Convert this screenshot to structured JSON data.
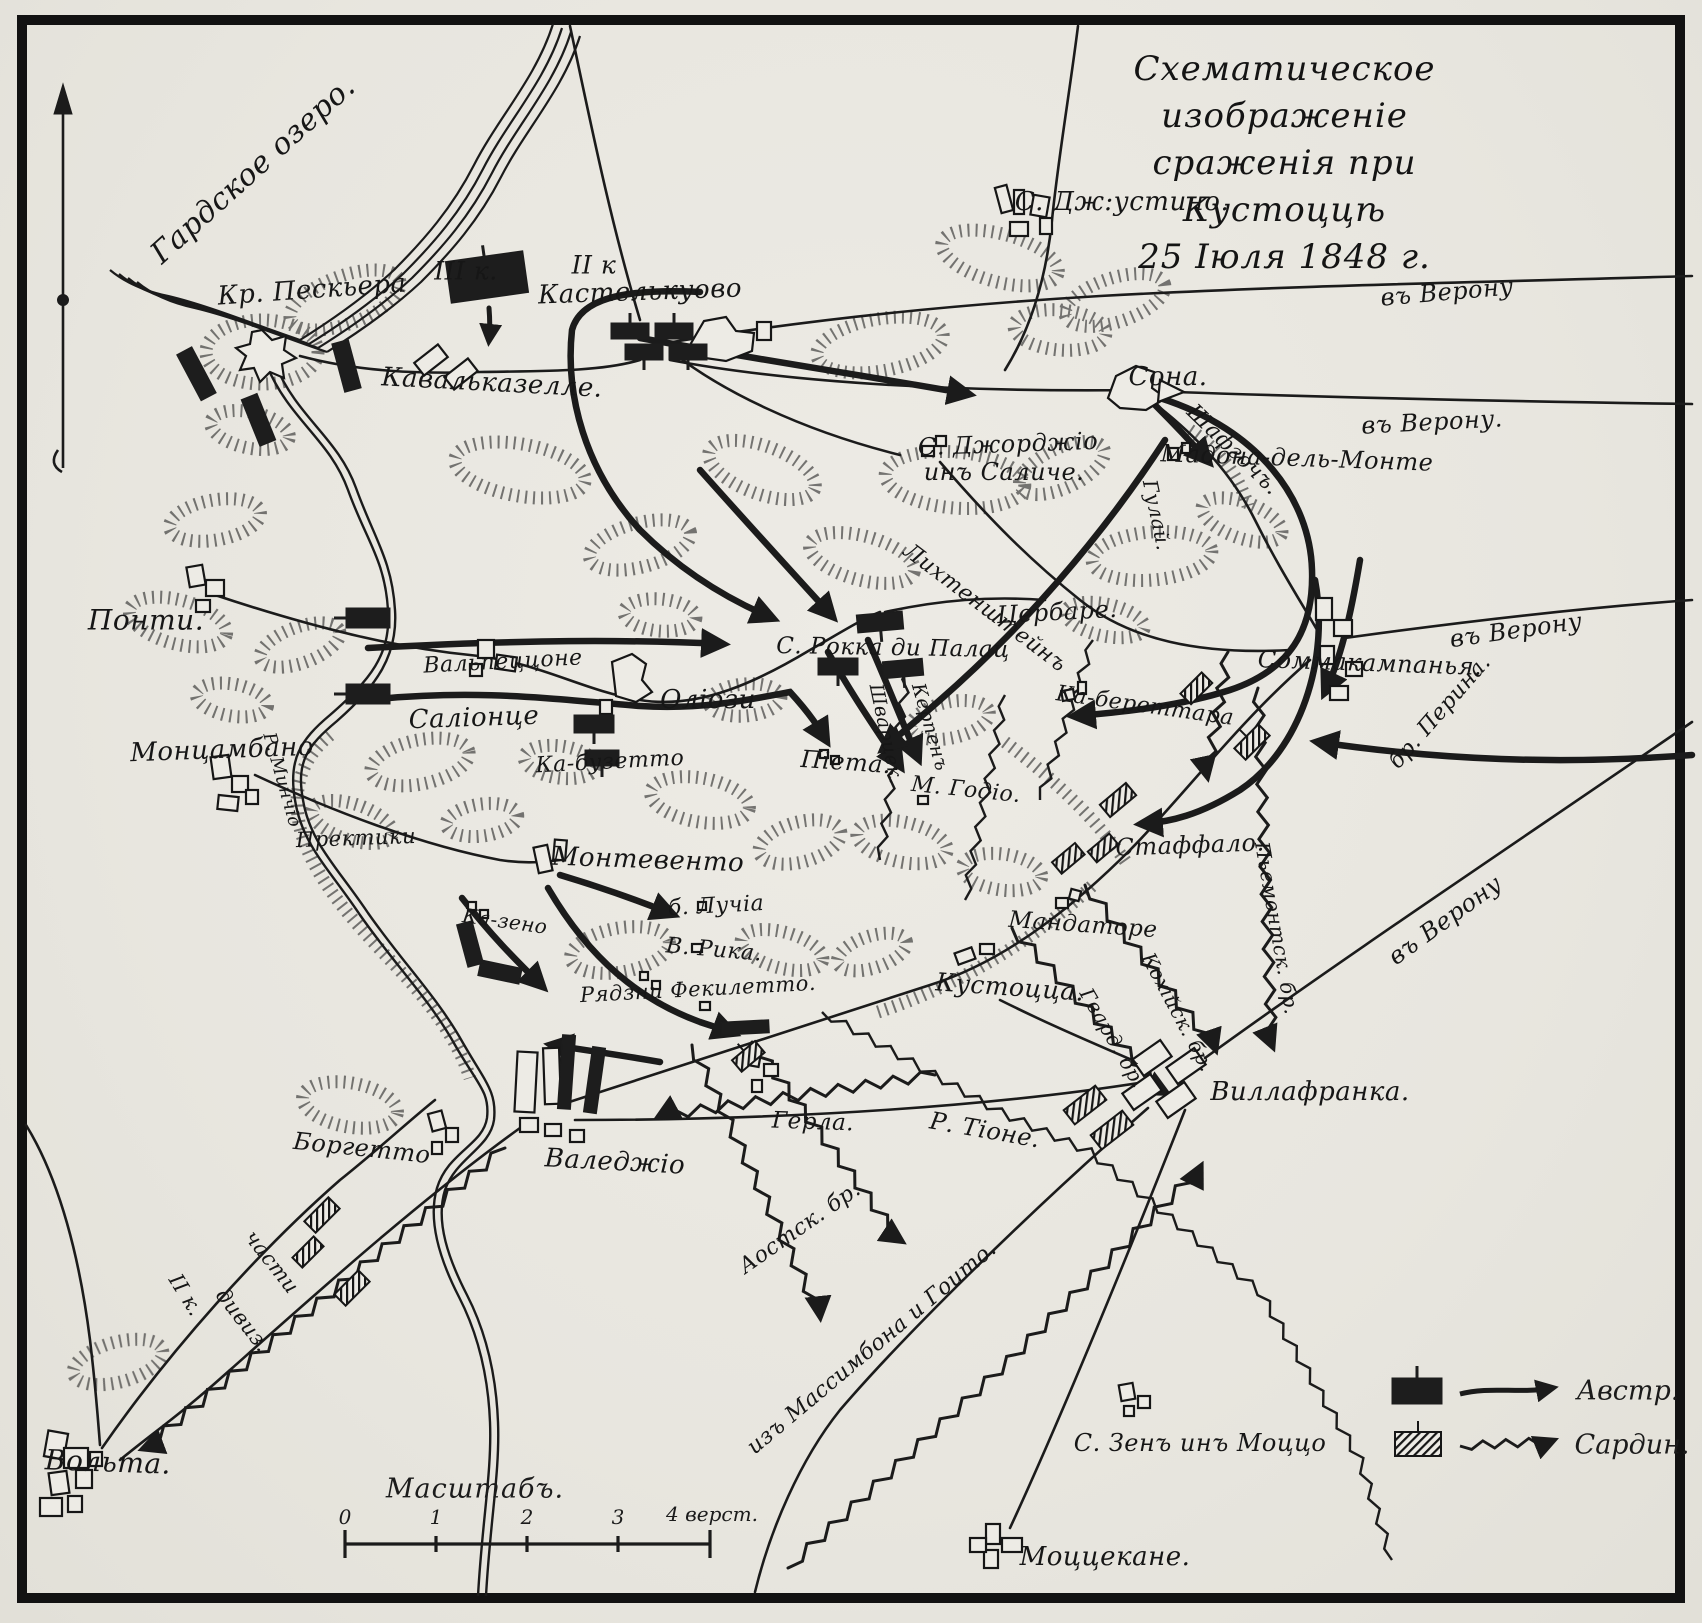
{
  "title": {
    "lines": [
      "Схематическое изображеніе",
      "сраженія при Кустоццѣ",
      "25 Іюля 1848 г."
    ]
  },
  "legend": {
    "austrian_label": "Австр.",
    "sardinian_label": "Сардин."
  },
  "scale": {
    "caption": "Масштабъ.",
    "tick_labels": [
      "0",
      "1",
      "2",
      "3"
    ],
    "end_label": "4 верст."
  },
  "compass": {
    "direction": "north"
  },
  "labels": [
    {
      "text": "Гардское озеро.",
      "x": 253,
      "y": 170,
      "size": 30,
      "rot": -42
    },
    {
      "text": "Кр. Пескьера",
      "x": 312,
      "y": 290,
      "size": 26,
      "rot": -4
    },
    {
      "text": "III к.",
      "x": 466,
      "y": 271,
      "size": 25,
      "rot": 0
    },
    {
      "text": "II к",
      "x": 594,
      "y": 265,
      "size": 25,
      "rot": 0
    },
    {
      "text": "Кастелькуово",
      "x": 640,
      "y": 292,
      "size": 26,
      "rot": -2
    },
    {
      "text": "Кавальказелле.",
      "x": 492,
      "y": 383,
      "size": 26,
      "rot": 3
    },
    {
      "text": "С. Дж:устино.",
      "x": 1122,
      "y": 202,
      "size": 26,
      "rot": 0
    },
    {
      "text": "въ Верону",
      "x": 1447,
      "y": 292,
      "size": 24,
      "rot": -5
    },
    {
      "text": "въ Верону.",
      "x": 1432,
      "y": 422,
      "size": 24,
      "rot": -3
    },
    {
      "text": "Сона.",
      "x": 1168,
      "y": 377,
      "size": 26,
      "rot": 0
    },
    {
      "text": "Шафгочъ.",
      "x": 1233,
      "y": 450,
      "size": 22,
      "rot": 44
    },
    {
      "text": "Мадона-дель-Монте",
      "x": 1297,
      "y": 458,
      "size": 24,
      "rot": 2
    },
    {
      "text": "Гулай.",
      "x": 1157,
      "y": 515,
      "size": 20,
      "rot": 78
    },
    {
      "text": "С. Джорджіо",
      "x": 1008,
      "y": 444,
      "size": 24,
      "rot": -2
    },
    {
      "text": "инъ Саличе.",
      "x": 1004,
      "y": 472,
      "size": 24,
      "rot": 0
    },
    {
      "text": "Лихтенштейнъ",
      "x": 985,
      "y": 608,
      "size": 22,
      "rot": 37
    },
    {
      "text": "Цербаре.",
      "x": 1057,
      "y": 612,
      "size": 24,
      "rot": -3
    },
    {
      "text": "Понти.",
      "x": 146,
      "y": 620,
      "size": 28,
      "rot": 0
    },
    {
      "text": "Вальпеццоне",
      "x": 503,
      "y": 662,
      "size": 22,
      "rot": -3
    },
    {
      "text": "Саліонце",
      "x": 474,
      "y": 718,
      "size": 26,
      "rot": -2
    },
    {
      "text": "Оліози",
      "x": 708,
      "y": 700,
      "size": 26,
      "rot": 0
    },
    {
      "text": "С. Рокка ди Палац",
      "x": 893,
      "y": 648,
      "size": 23,
      "rot": 1
    },
    {
      "text": "Ка-бузетто",
      "x": 610,
      "y": 762,
      "size": 22,
      "rot": -3
    },
    {
      "text": "Піета.",
      "x": 846,
      "y": 762,
      "size": 24,
      "rot": 4
    },
    {
      "text": "Шварцек.",
      "x": 886,
      "y": 734,
      "size": 19,
      "rot": 78
    },
    {
      "text": "Керпенъ",
      "x": 930,
      "y": 727,
      "size": 19,
      "rot": 74
    },
    {
      "text": "М. Годіо.",
      "x": 966,
      "y": 790,
      "size": 22,
      "rot": 6
    },
    {
      "text": "Ка-береттара",
      "x": 1145,
      "y": 706,
      "size": 22,
      "rot": 8
    },
    {
      "text": "Соммакампанья.",
      "x": 1370,
      "y": 663,
      "size": 24,
      "rot": 2
    },
    {
      "text": "въ Верону",
      "x": 1516,
      "y": 630,
      "size": 24,
      "rot": -8
    },
    {
      "text": "бр. Перина.",
      "x": 1440,
      "y": 712,
      "size": 22,
      "rot": -49
    },
    {
      "text": "Стаффало.",
      "x": 1190,
      "y": 845,
      "size": 24,
      "rot": -2
    },
    {
      "text": "Пьемонтск. бр.",
      "x": 1277,
      "y": 928,
      "size": 20,
      "rot": 80
    },
    {
      "text": "Монцамбано",
      "x": 222,
      "y": 750,
      "size": 26,
      "rot": -2
    },
    {
      "text": "Р. Минчіо",
      "x": 282,
      "y": 780,
      "size": 18,
      "rot": 74
    },
    {
      "text": "Пректики",
      "x": 356,
      "y": 838,
      "size": 21,
      "rot": -2
    },
    {
      "text": "Монтевенто",
      "x": 648,
      "y": 860,
      "size": 26,
      "rot": 2
    },
    {
      "text": "б. Лучіа",
      "x": 716,
      "y": 906,
      "size": 22,
      "rot": -3
    },
    {
      "text": "В. Рика.",
      "x": 714,
      "y": 950,
      "size": 22,
      "rot": 5
    },
    {
      "text": "Рядзни Фекилетто.",
      "x": 698,
      "y": 989,
      "size": 21,
      "rot": -3
    },
    {
      "text": "Ка-зено",
      "x": 505,
      "y": 921,
      "size": 20,
      "rot": 8
    },
    {
      "text": "Кустоцца.",
      "x": 1010,
      "y": 987,
      "size": 25,
      "rot": 4
    },
    {
      "text": "Мандаторе",
      "x": 1083,
      "y": 925,
      "size": 23,
      "rot": 4
    },
    {
      "text": "Гвард. бр.",
      "x": 1113,
      "y": 1038,
      "size": 20,
      "rot": 60
    },
    {
      "text": "Кохійск. бр.",
      "x": 1178,
      "y": 1012,
      "size": 20,
      "rot": 62
    },
    {
      "text": "Р. Тіоне.",
      "x": 985,
      "y": 1130,
      "size": 24,
      "rot": 10
    },
    {
      "text": "Виллафранка.",
      "x": 1310,
      "y": 1092,
      "size": 26,
      "rot": 0
    },
    {
      "text": "Герла.",
      "x": 813,
      "y": 1122,
      "size": 23,
      "rot": 2
    },
    {
      "text": "Валеджіо",
      "x": 615,
      "y": 1162,
      "size": 26,
      "rot": 3
    },
    {
      "text": "Боргетто",
      "x": 362,
      "y": 1148,
      "size": 24,
      "rot": 6
    },
    {
      "text": "части",
      "x": 272,
      "y": 1262,
      "size": 21,
      "rot": 52
    },
    {
      "text": "дивиз.",
      "x": 243,
      "y": 1320,
      "size": 21,
      "rot": 52
    },
    {
      "text": "II к.",
      "x": 186,
      "y": 1295,
      "size": 21,
      "rot": 58
    },
    {
      "text": "Вольта.",
      "x": 108,
      "y": 1462,
      "size": 28,
      "rot": 2
    },
    {
      "text": "изъ Массимбона и Гоито.",
      "x": 872,
      "y": 1348,
      "size": 22,
      "rot": -40
    },
    {
      "text": "С. Зенъ инъ Моццо",
      "x": 1200,
      "y": 1443,
      "size": 24,
      "rot": 0
    },
    {
      "text": "Моццекане.",
      "x": 1105,
      "y": 1557,
      "size": 26,
      "rot": 0
    },
    {
      "text": "Аостск. бр.",
      "x": 800,
      "y": 1228,
      "size": 22,
      "rot": -35
    },
    {
      "text": "въ Верону",
      "x": 1445,
      "y": 920,
      "size": 24,
      "rot": -36
    }
  ]
}
